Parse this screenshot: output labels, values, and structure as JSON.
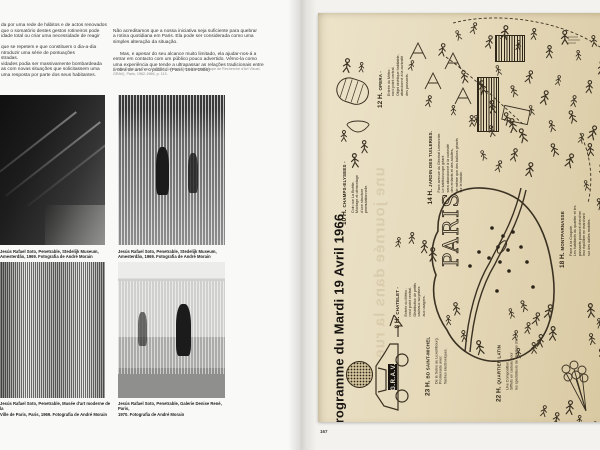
{
  "left_page": {
    "column_left": "da por uma rede de hábitos e de actos renovados\nque o somatório destes gestos rotineiros pode\nidade total ou criar uma necessidade de reagir\n\nque se repetem e que constituem o dia-a-dia\nntroduzir uma série de pontuações\nstradas.\nvidades podia ser massivamente bombardeada\nas com novas situações que solicitassem uma\numa resposta por parte dos seus habitantes.",
    "column_right_p1": "Não acreditamos que a nossa iniciativa seja suficiente para quebrar\na rotina quotidiana em Paris. Ela pode ser considerada como uma\nsimples alteração da situação.",
    "column_right_p2": "Mas, e apesar do seu alcance muito limitado, ela ajudar-nos-á a\nentrar em contacto com um público pouco advertido. Vêmo-la como\numa experiência que tende a ultrapassar as relações tradicionais entre\na obra de arte e o público. (Paris, 1964-1966)",
    "citation": "Garcia Rossi; Le Parc; Morellet; Sobrino; Stein; Yvaral (Groupe de Recherche d'Art Visuel,\nGRAV), Paris, 1962-1966, p. 113.",
    "captions": [
      "Jesús Rafael Soto, Penetrable, Stedelijk Museum,\nAmesterdão, 1969. Fotografia de André Morain",
      "Jesús Rafael Soto, Penetrable, Stedelijk Museum,\nAmesterdão, 1969. Fotografia de André Morain",
      "Jesús Rafael Soto, Penetrable, Musée d'art moderne de la\nVille de Paris, Paris, 1969. Fotografia de André Morain",
      "Jesús Rafael Soto, Penetrable, Galerie Denise René, Paris,\n1970. Fotografia de André Morain"
    ]
  },
  "right_page": {
    "page_number": "167",
    "poster": {
      "title": "Programme du Mardi 19 Avril 1966",
      "map_label": "PARIS",
      "vehicle_plate": "G.R.A.V.",
      "ghost_text": "une journée dans la rue",
      "entries": [
        {
          "time": "8 H.",
          "place": "CHATELET -",
          "desc": "Entrée du Métro :\nrond point central.\nDistribution de petits\ncadeaux surprises\naux usagers."
        },
        {
          "time": "10 H.",
          "place": "CHAMPS-ELYSEES -",
          "desc": "Coin rue La Boétie.\nMontage et démontage\nd'une structure\npermutationnelle."
        },
        {
          "time": "12 H.",
          "place": "OPERA -",
          "desc": "Entrée du Métro :\nrond point central.\nObjet cinétique habitable,\nabandonné à la curiosité\ndes passants."
        },
        {
          "time": "14 H.",
          "place": "JARDIN DES TUILERIES.",
          "desc": "Face avenue du Général Lemonnier.\nLe kaléidoscope géant\nsera abandonné à la curiosité\ndes enfants et des adultes,\nde même que des ballons géants\nsur le bassin."
        },
        {
          "time": "18 H.",
          "place": "MONTPARNASSE",
          "desc": "Face à la Coupole.\nLes habitants du quartier et les\npassants pourront chercher\nleur équilibre en marchant\nsur des dalles mobiles."
        },
        {
          "time": "22 H.",
          "place": "QUARTIER LATIN",
          "desc": "Une Composition.\nSifflets en cadeau pour\nles spectateurs de cinémas d'art."
        },
        {
          "time": "23 H.",
          "place": "BD SAINT-MICHEL",
          "desc": "De la Seine au Luxembourg.\nPromenade avec\nflashes électroniques."
        }
      ]
    }
  }
}
